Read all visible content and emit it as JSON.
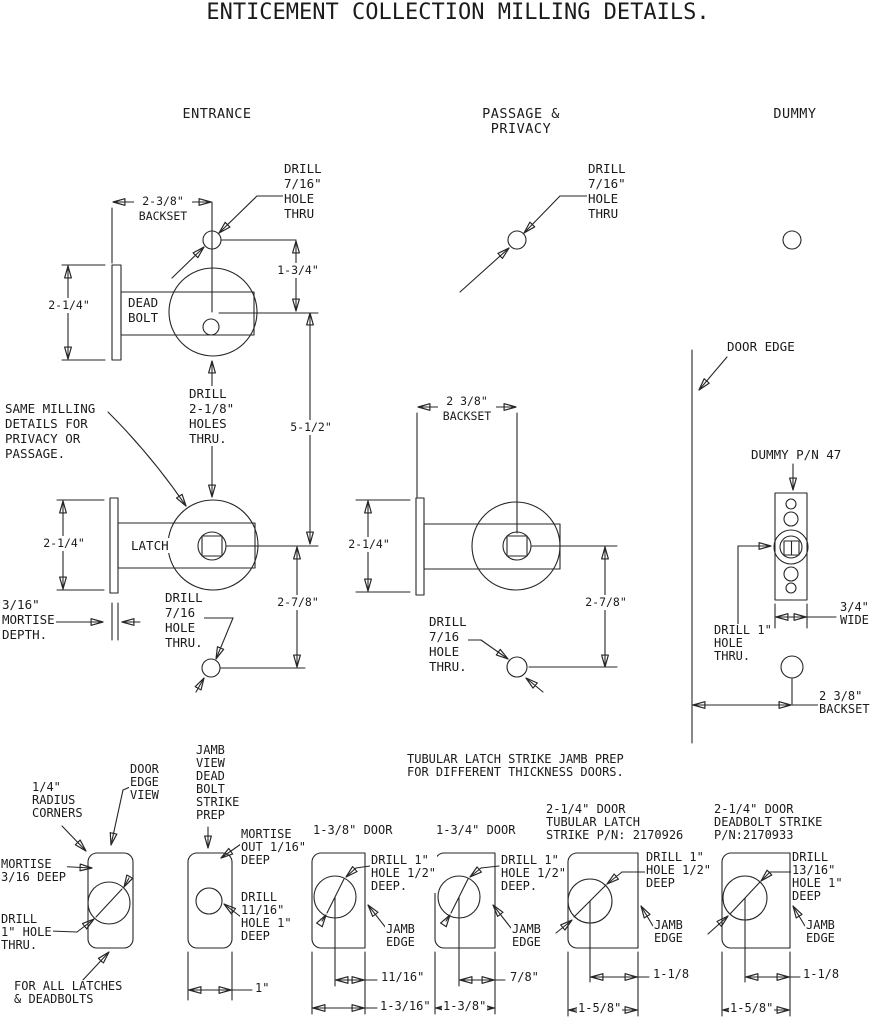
{
  "title": "ENTICEMENT COLLECTION MILLING DETAILS.",
  "colors": {
    "ink": "#262626",
    "paper": "#ffffff"
  },
  "sections": {
    "entrance": {
      "heading": "ENTRANCE",
      "backset": "2-3/8\"\nBACKSET",
      "drill_top": "DRILL\n7/16\"\nHOLE\nTHRU",
      "dim_hole_spacing": "1-3/4\"",
      "deadbolt_label": "DEAD\nBOLT",
      "dim_deadbolt_height": "2-1/4\"",
      "drill_cross": "DRILL\n2-1/8\"\nHOLES\nTHRU.",
      "dim_center_spacing": "5-1/2\"",
      "note_same_milling": "SAME MILLING\nDETAILS FOR\nPRIVACY OR\nPASSAGE.",
      "dim_latch_height": "2-1/4\"",
      "latch_label": "LATCH",
      "mortise_depth": "3/16\"\nMORTISE\nDEPTH.",
      "drill_bottom": "DRILL\n7/16\nHOLE\nTHRU.",
      "dim_bottom_spacing": "2-7/8\""
    },
    "passage_privacy": {
      "heading": "PASSAGE & PRIVACY",
      "drill_top": "DRILL\n7/16\"\nHOLE\nTHRU",
      "backset": "2 3/8\"\nBACKSET",
      "dim_latch_height": "2-1/4\"",
      "dim_bottom_spacing": "2-7/8\"",
      "drill_bottom": "DRILL\n7/16\nHOLE\nTHRU."
    },
    "dummy": {
      "heading": "DUMMY",
      "door_edge": "DOOR EDGE",
      "part_note": "DUMMY P/N 47",
      "plate_width": "3/4\"\nWIDE",
      "drill": "DRILL 1\"\nHOLE\nTHRU.",
      "backset": "2 3/8\"\nBACKSET"
    }
  },
  "strike_prep": {
    "heading": "TUBULAR LATCH STRIKE JAMB PREP\nFOR DIFFERENT THICKNESS DOORS.",
    "edge_view": {
      "radius_note": "1/4\"\nRADIUS\nCORNERS",
      "view_label": "DOOR\nEDGE\nVIEW",
      "mortise_note": "MORTISE\n3/16 DEEP",
      "drill_note": "DRILL\n1\" HOLE\nTHRU.",
      "applies_note": "FOR ALL LATCHES\n& DEADBOLTS"
    },
    "jamb_view": {
      "title": "JAMB\nVIEW\nDEAD\nBOLT\nSTRIKE\nPREP",
      "mortise_note": "MORTISE\nOUT 1/16\"\nDEEP",
      "drill_note": "DRILL\n11/16\"\nHOLE 1\"\nDEEP",
      "width": "1\""
    },
    "door_1_38": {
      "title": "1-3/8\" DOOR",
      "drill_note": "DRILL 1\"\nHOLE 1/2\"\nDEEP.",
      "jamb_edge": "JAMB\nEDGE",
      "offset": "11/16\"",
      "width": "1-3/16\""
    },
    "door_1_34": {
      "title": "1-3/4\" DOOR",
      "drill_note": "DRILL 1\"\nHOLE 1/2\"\nDEEP.",
      "jamb_edge": "JAMB\nEDGE",
      "offset": "7/8\"",
      "width": "1-3/8\""
    },
    "door_2_14_latch": {
      "title": "2-1/4\" DOOR\nTUBULAR LATCH\nSTRIKE P/N: 2170926",
      "drill_note": "DRILL 1\"\nHOLE 1/2\"\nDEEP",
      "jamb_edge": "JAMB\nEDGE",
      "offset": "1-1/8",
      "width": "1-5/8\""
    },
    "door_2_14_deadbolt": {
      "title": "2-1/4\" DOOR\nDEADBOLT STRIKE\nP/N:2170933",
      "drill_note": "DRILL 13/16\"\nHOLE 1\"\nDEEP",
      "jamb_edge": "JAMB\nEDGE",
      "offset": "1-1/8",
      "width": "1-5/8\""
    }
  }
}
